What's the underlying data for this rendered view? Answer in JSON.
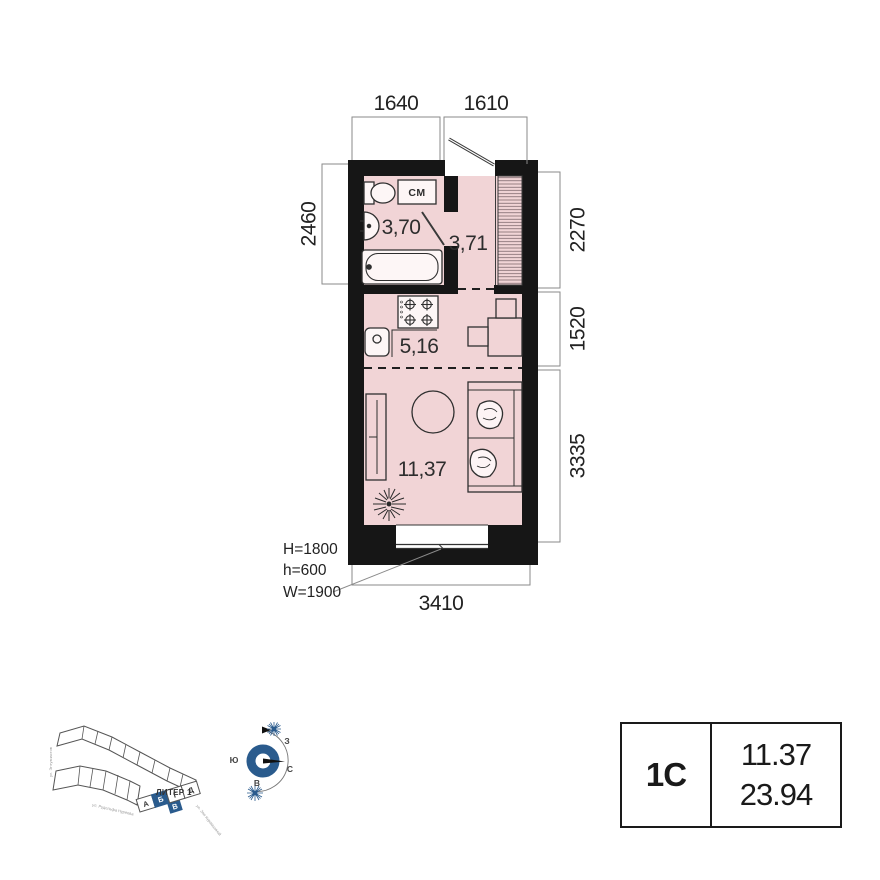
{
  "plan": {
    "rooms": [
      {
        "name": "bathroom",
        "area": "3,70"
      },
      {
        "name": "hallway",
        "area": "3,71"
      },
      {
        "name": "kitchen",
        "area": "5,16"
      },
      {
        "name": "living",
        "area": "11,37"
      }
    ],
    "fixture_labels": {
      "washing_machine": "СМ"
    },
    "dimensions": {
      "top_left": "1640",
      "top_right": "1610",
      "left": "2460",
      "right_top": "2270",
      "right_mid": "1520",
      "right_bottom": "3335",
      "bottom": "3410"
    },
    "window_annotation": {
      "line1": "H=1800",
      "line2": "h=600",
      "line3": "W=1900"
    }
  },
  "site_plan": {
    "liter": "ЛИТЕР 1",
    "sections": [
      "А",
      "Б",
      "В",
      "Г",
      "Д"
    ],
    "streets": [
      "ул. Энтузиастов",
      "ул. Рудольфа Нуреева",
      "ул. Зои Курамшиной"
    ]
  },
  "compass": {
    "west": "З",
    "south": "Ю",
    "north": "С",
    "east": "В"
  },
  "spec_table": {
    "unit_type": "1С",
    "living_area": "11.37",
    "total_area": "23.94"
  },
  "colors": {
    "room_fill": "#f1d4d6",
    "wall": "#161616",
    "accent_blue": "#2a5b8d",
    "dim_line": "#8a8a8a"
  }
}
